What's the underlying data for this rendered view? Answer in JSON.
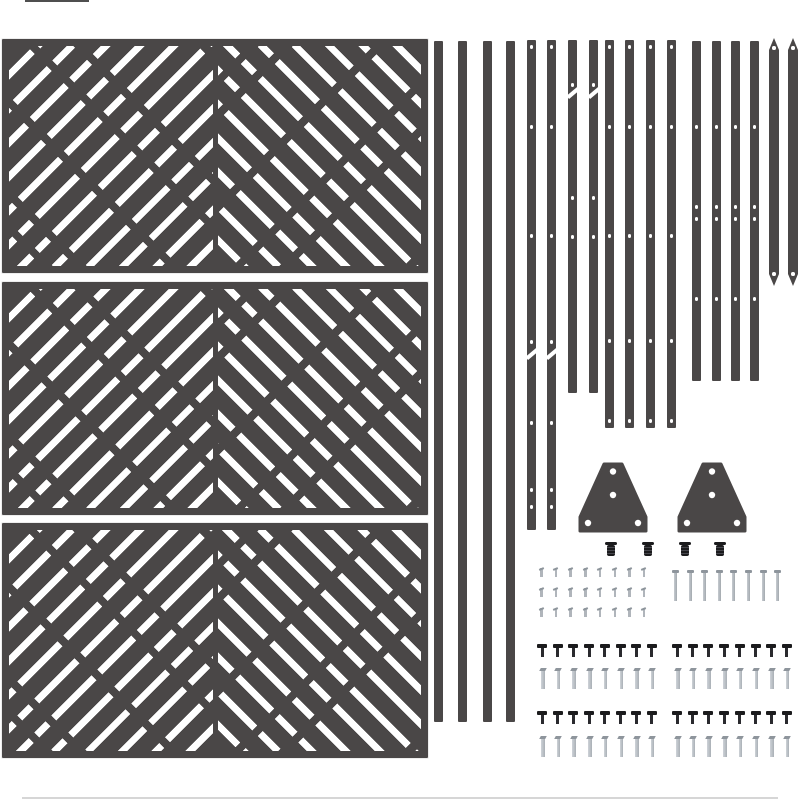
{
  "image": {
    "width": 800,
    "height": 800,
    "background": "#ffffff",
    "description": "Fence privacy screen kit parts laid out on white: three chevron lattice panels, eighteen drilled rails, two gusset brackets, fastener sets"
  },
  "colors": {
    "bg": "#ffffff",
    "part_dark": "#4a4747",
    "stripe_white": "#ffffff",
    "hole": "#ffffff",
    "edge_light": "#ededed",
    "hardware_black": "#1b1b1d",
    "hardware_gray": "#b0b5bb",
    "hardware_gray_dark": "#8e959c"
  },
  "counts": {
    "panels": 3,
    "slats": 18,
    "brackets": 2,
    "plug_bolts": 4,
    "small_screws": 24,
    "long_nails": 8,
    "black_screws": 32,
    "silver_screws": 32
  },
  "panels": {
    "x": 2,
    "width": 426,
    "frame": 7,
    "items": [
      {
        "y": 39,
        "height": 234
      },
      {
        "y": 282,
        "height": 233
      },
      {
        "y": 523,
        "height": 235
      }
    ]
  },
  "slats": {
    "default_width": 9,
    "items": [
      {
        "x": 434,
        "top": 41,
        "bottom": 722
      },
      {
        "x": 458,
        "top": 41,
        "bottom": 722
      },
      {
        "x": 483,
        "top": 41,
        "bottom": 722
      },
      {
        "x": 506,
        "top": 41,
        "bottom": 722
      },
      {
        "x": 527,
        "top": 40,
        "bottom": 530,
        "holes": [
          47,
          127,
          236,
          342,
          423,
          490,
          507
        ],
        "notches": [
          352
        ]
      },
      {
        "x": 547,
        "top": 40,
        "bottom": 530,
        "holes": [
          47,
          127,
          236,
          342,
          423,
          490,
          507
        ],
        "notches": [
          352
        ]
      },
      {
        "x": 568,
        "top": 40,
        "bottom": 393,
        "holes": [
          85,
          198,
          237
        ],
        "notches": [
          91
        ]
      },
      {
        "x": 589,
        "top": 40,
        "bottom": 393,
        "holes": [
          85,
          198,
          237
        ],
        "notches": [
          91
        ]
      },
      {
        "x": 605,
        "top": 40,
        "bottom": 428,
        "holes": [
          47,
          127,
          236,
          341,
          421
        ]
      },
      {
        "x": 625,
        "top": 40,
        "bottom": 428,
        "holes": [
          47,
          127,
          236,
          341,
          421
        ]
      },
      {
        "x": 646,
        "top": 40,
        "bottom": 428,
        "holes": [
          47,
          127,
          236,
          341,
          421
        ]
      },
      {
        "x": 667,
        "top": 40,
        "bottom": 428,
        "holes": [
          47,
          127,
          236,
          341,
          421
        ]
      },
      {
        "x": 692,
        "top": 41,
        "bottom": 381,
        "holes": [
          127,
          207,
          219,
          299
        ]
      },
      {
        "x": 712,
        "top": 41,
        "bottom": 381,
        "holes": [
          127,
          207,
          219,
          299
        ]
      },
      {
        "x": 731,
        "top": 41,
        "bottom": 381,
        "holes": [
          127,
          207,
          219,
          299
        ]
      },
      {
        "x": 750,
        "top": 41,
        "bottom": 381,
        "holes": [
          127,
          207,
          219,
          299
        ]
      },
      {
        "x": 769,
        "top": 38,
        "bottom": 286,
        "width": 10,
        "pointed": true,
        "holes": [
          48,
          274
        ]
      },
      {
        "x": 788,
        "top": 38,
        "bottom": 286,
        "width": 10,
        "pointed": true,
        "holes": [
          48,
          274
        ]
      }
    ]
  },
  "brackets": {
    "width": 70,
    "height": 71,
    "polygon": "26,2 44,2 68,55 68,69 2,69 2,55",
    "holes": [
      [
        35,
        9.5
      ],
      [
        35,
        33
      ],
      [
        10,
        61
      ],
      [
        60,
        61
      ]
    ],
    "hole_radius": 3.2,
    "positions": [
      {
        "x": 578,
        "y": 462
      },
      {
        "x": 677,
        "y": 462
      }
    ]
  },
  "plug_bolts": {
    "y": 542,
    "x_centers": [
      611,
      648,
      685,
      720
    ]
  },
  "small_screw_grid": {
    "x0": 540,
    "dx": 14.7,
    "cols": 8,
    "row_y": [
      568,
      588,
      608
    ]
  },
  "long_nail_row": {
    "x0": 674,
    "dx": 14.6,
    "count": 8,
    "y": 570
  },
  "screw_rows": [
    {
      "type": "black",
      "x0": 540.5,
      "dx": 15.7,
      "count": 8,
      "y": 644
    },
    {
      "type": "black",
      "x0": 675.5,
      "dx": 15.7,
      "count": 8,
      "y": 644
    },
    {
      "type": "silver",
      "x0": 541,
      "dx": 15.7,
      "count": 8,
      "y": 668
    },
    {
      "type": "silver",
      "x0": 676,
      "dx": 15.7,
      "count": 8,
      "y": 668
    },
    {
      "type": "black",
      "x0": 540.5,
      "dx": 15.7,
      "count": 8,
      "y": 711
    },
    {
      "type": "black",
      "x0": 675.5,
      "dx": 15.7,
      "count": 8,
      "y": 711
    },
    {
      "type": "silver",
      "x0": 541,
      "dx": 15.7,
      "count": 8,
      "y": 736
    },
    {
      "type": "silver",
      "x0": 676,
      "dx": 15.7,
      "count": 8,
      "y": 736
    }
  ],
  "edge_marks": [
    {
      "x": 25,
      "y": 0,
      "w": 64,
      "h": 2,
      "color": "#4f4f4f"
    },
    {
      "x": 22,
      "y": 797,
      "w": 756,
      "h": 1.5,
      "color": "#d6d6d6"
    }
  ]
}
